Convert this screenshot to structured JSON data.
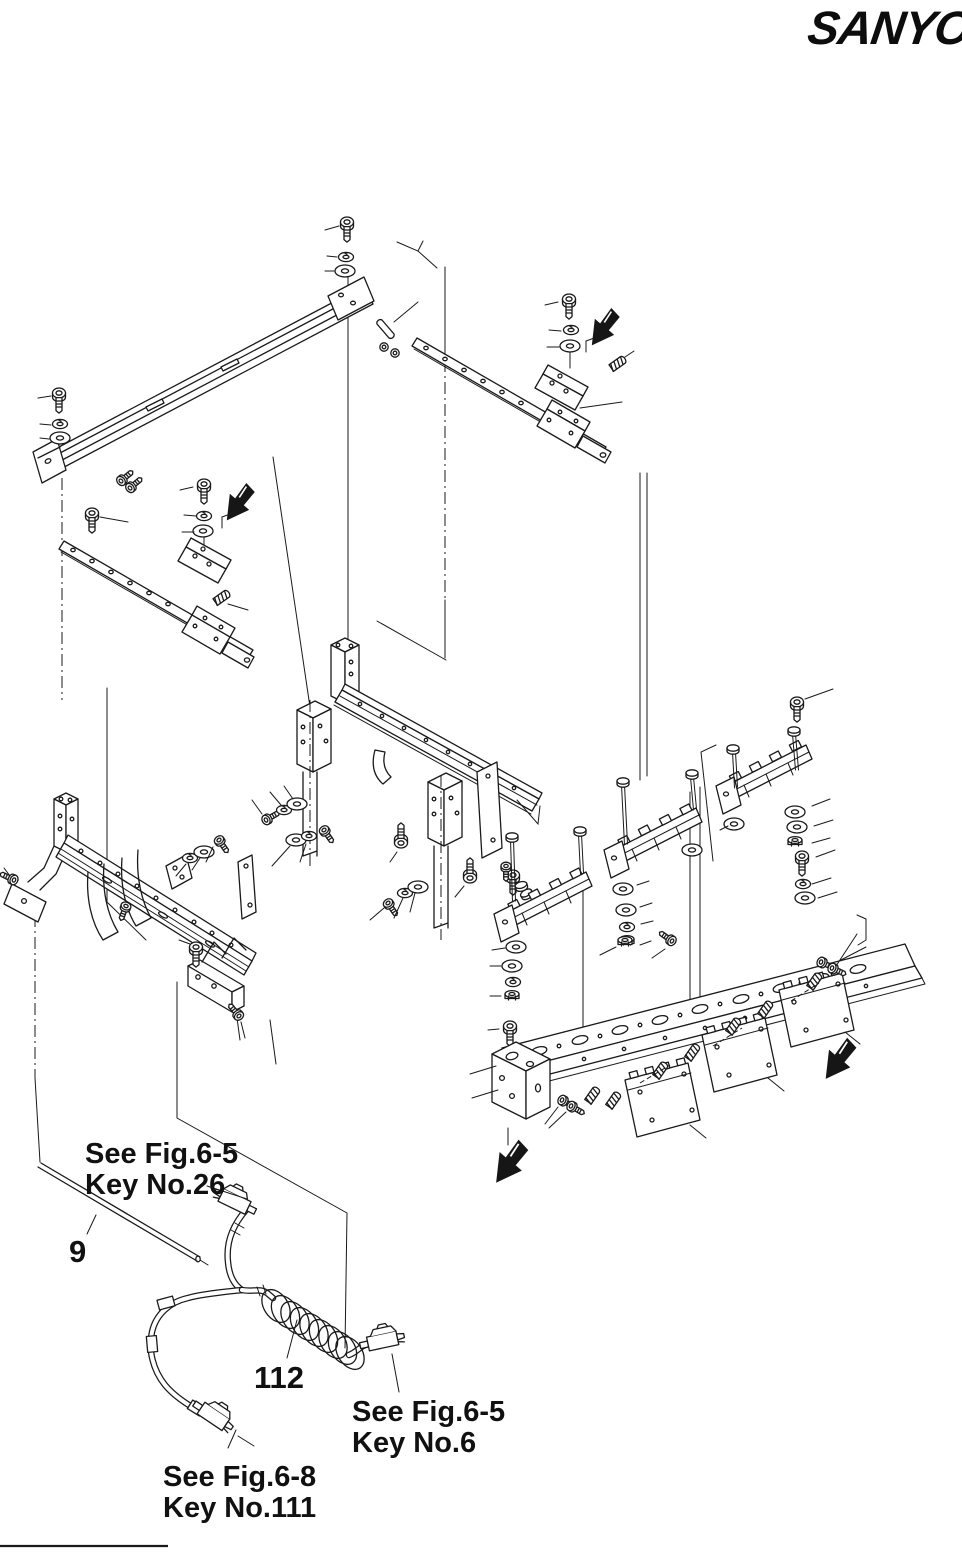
{
  "page": {
    "paper_color": "#ffffff",
    "ink_color": "#1a1a1a"
  },
  "logo": {
    "text": "SANYO"
  },
  "callouts": {
    "ref26": {
      "line1": "See Fig.6-5",
      "line2": "Key No.26"
    },
    "part9": {
      "label": "9"
    },
    "part112": {
      "label": "112"
    },
    "ref6": {
      "line1": "See Fig.6-5",
      "line2": "Key No.6"
    },
    "ref111": {
      "line1": "See Fig.6-8",
      "line2": "Key No.111"
    }
  },
  "icons": {
    "direction_arrow": "filled-bent-arrow-down-left"
  }
}
